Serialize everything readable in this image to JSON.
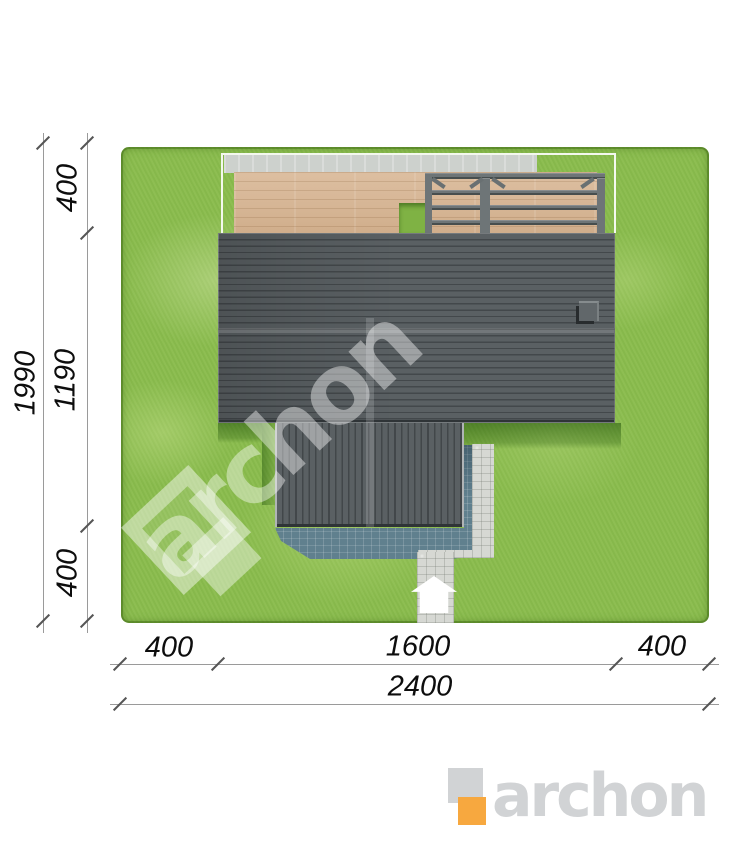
{
  "plan_labels": {
    "dim_left_total": "1990",
    "dim_left_top": "400",
    "dim_left_middle": "1190",
    "dim_left_bottom": "400",
    "dim_bottom_left": "400",
    "dim_bottom_middle": "1600",
    "dim_bottom_right": "400",
    "dim_bottom_total": "2400"
  },
  "watermark": {
    "text": "archon"
  },
  "logo": {
    "text": "archon",
    "accent_color": "#f7a83f",
    "gray_color": "#d1d3d5"
  },
  "palette": {
    "grass": "#8abc4d",
    "roof_tiles": "#54595c",
    "deck_wood": "#d8b694",
    "concrete_strip": "#cdd1cd",
    "pergola_beams": "#6e7577",
    "shadow_pavers": "#60808e",
    "light_path": "#d6d8d3",
    "dimension_text": "#0d0d0d"
  }
}
